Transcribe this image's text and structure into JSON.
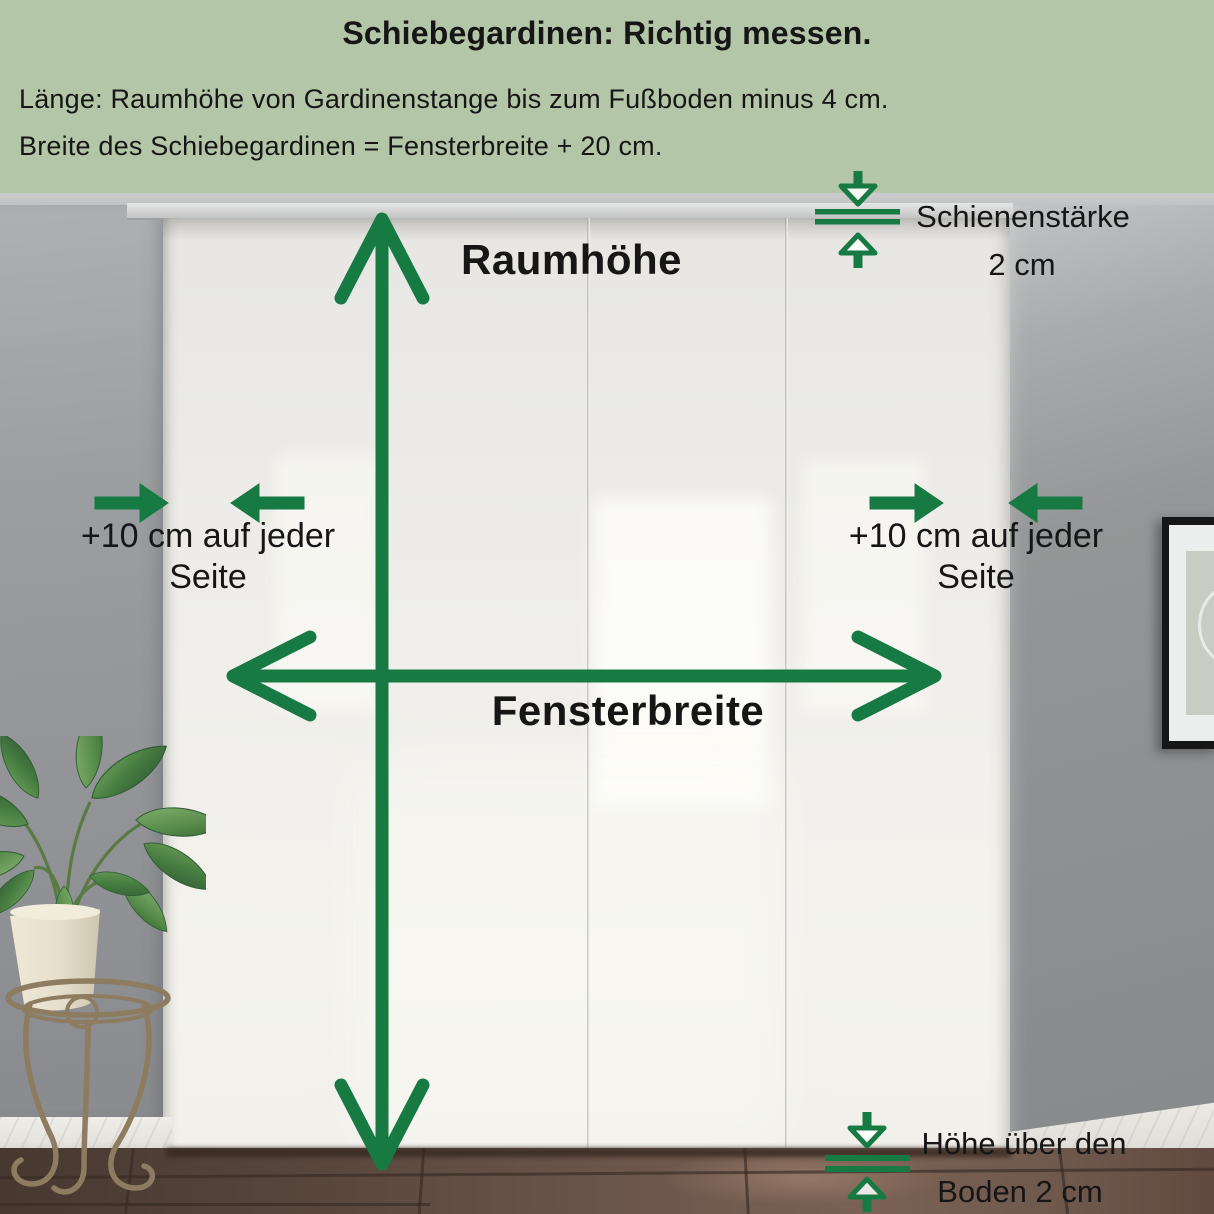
{
  "header": {
    "title": "Schiebegardinen: Richtig messen.",
    "subtitle_line1": "Länge: Raumhöhe von Gardinenstange bis zum Fußboden minus 4 cm.",
    "subtitle_line2": "Breite des Schiebegardinen = Fensterbreite + 20 cm."
  },
  "annotations": {
    "room_height_label": "Raumhöhe",
    "window_width_label": "Fensterbreite",
    "left_margin_label_line1": "+10 cm auf jeder",
    "left_margin_label_line2": "Seite",
    "right_margin_label_line1": "+10 cm auf jeder",
    "right_margin_label_line2": "Seite",
    "rail_label_line1": "Schienenstärke",
    "rail_label_line2": "2 cm",
    "floor_clearance_label_line1": "Höhe über den",
    "floor_clearance_label_line2": "Boden 2 cm"
  },
  "theme": {
    "header_bg": "#b3c6a8",
    "arrow_green": "#177a42",
    "text_dark": "#161616",
    "wall_gray": "#97999b",
    "curtain_white": "#f0efeb",
    "floor_brown": "#69544a",
    "baseboard_marble": "#e8e6e1",
    "pot_cream": "#e7dfcc",
    "leaf_green": "#477c41",
    "stand_bronze": "#8d7c60",
    "frame_black": "#161616"
  }
}
